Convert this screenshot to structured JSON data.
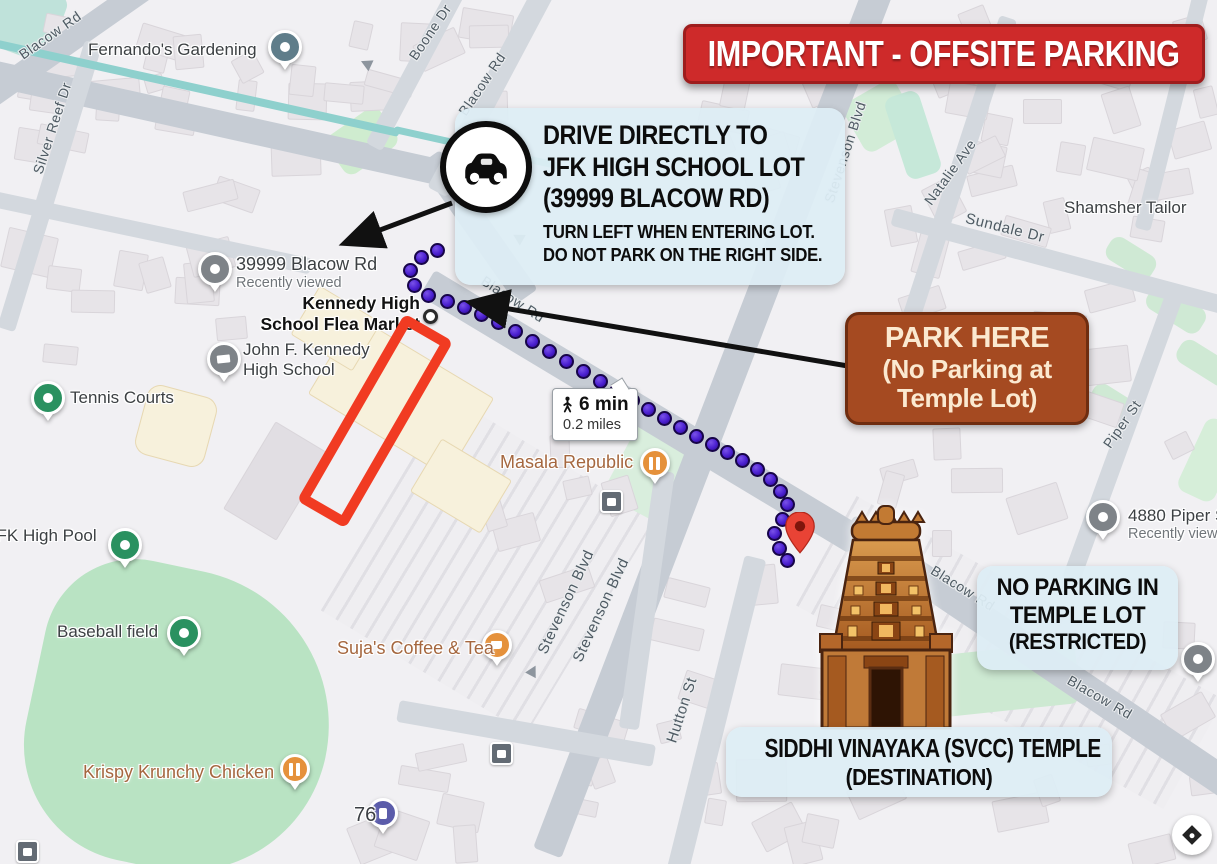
{
  "banner": {
    "text": "IMPORTANT - OFFSITE PARKING",
    "bg_color": "#ce2a2a"
  },
  "drive_box": {
    "lines": [
      "DRIVE DIRECTLY TO",
      "JFK HIGH SCHOOL LOT",
      "(39999 BLACOW RD)"
    ],
    "sublines": [
      "TURN LEFT WHEN ENTERING LOT.",
      "DO NOT PARK ON THE RIGHT SIDE."
    ]
  },
  "park_box": {
    "lines": [
      "PARK HERE",
      "(No Parking at",
      "Temple Lot)"
    ],
    "bg_color": "#a54a21"
  },
  "no_parking_box": {
    "lines": [
      "NO PARKING IN",
      "TEMPLE LOT",
      "(RESTRICTED)"
    ]
  },
  "destination_box": {
    "lines": [
      "SIDDHI VINAYAKA (SVCC) TEMPLE",
      "(DESTINATION)"
    ]
  },
  "route": {
    "mode": "walking",
    "duration": "6 min",
    "distance": "0.2 miles",
    "color": "#4a1fd0"
  },
  "pois": {
    "fernandos": {
      "name": "Fernando's Gardening"
    },
    "blacow_39999": {
      "name": "39999 Blacow Rd",
      "sub": "Recently viewed"
    },
    "flea_market": {
      "line1": "Kennedy High",
      "line2": "School Flea Market"
    },
    "jfk_high": {
      "line1": "John F. Kennedy",
      "line2": "High School"
    },
    "tennis_courts": {
      "name": "Tennis Courts"
    },
    "jfk_pool": {
      "name": "JFK High Pool"
    },
    "baseball_field": {
      "name": "Baseball field"
    },
    "masala_republic": {
      "name": "Masala Republic"
    },
    "sujas_coffee": {
      "name": "Suja's Coffee & Tea"
    },
    "krispy_krunchy": {
      "name": "Krispy Krunchy Chicken"
    },
    "station_76": {
      "name": "76"
    },
    "shamsher_tailor": {
      "name": "Shamsher Tailor"
    },
    "piper_4880": {
      "name": "4880 Piper St",
      "sub": "Recently viewed"
    }
  },
  "streets": {
    "blacow": "Blacow Rd",
    "silver_reef": "Silver Reef Dr",
    "boone": "Boone Dr",
    "stevenson": "Stevenson Blvd",
    "natalie": "Natalie Ave",
    "sundale": "Sundale Dr",
    "piper": "Piper St",
    "hutton": "Hutton St"
  },
  "icons": {
    "car-icon": "black car in circle",
    "walking-icon": "pedestrian figure",
    "temple-icon": "gopuram temple tower illustration",
    "destination-pin-icon": "red map pin",
    "transit-icon": "bus stop square",
    "map-control-icon": "round white map button"
  },
  "colors": {
    "banner_red": "#ce2a2a",
    "park_brown": "#a54a21",
    "route_purple": "#4a1fd0",
    "highlight_red": "#f13b22",
    "info_box_blue": "#dcedf4"
  }
}
